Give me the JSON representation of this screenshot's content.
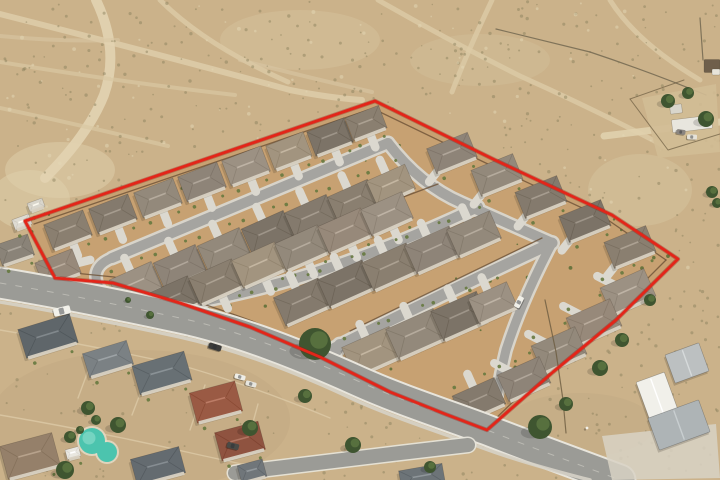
{
  "meta": {
    "description": "Oblique aerial photograph of a desert housing subdivision outlined with a red property-boundary line; older neighborhood with swimming pool at lower left, open desert with dirt trails above, white metal outbuildings at right",
    "image_width": 720,
    "image_height": 480
  },
  "colors": {
    "desert_base": "#cbb28a",
    "site_dirt": "#c7a172",
    "boundary_red": "#e32519",
    "boundary_under": "#8e1a10",
    "road_asphalt": "#9b9b96",
    "road_curb": "#e8e5dc",
    "street_asphalt": "#a5a4a0",
    "street_curb": "#d8d4ca",
    "driveway": "#dbd8cf",
    "house_wall": "#d8d1c2",
    "fence_brown": "#6d5136",
    "pool_water": "#4cc4ae",
    "tree_green": "#3f5530"
  },
  "desert": {
    "base": "#cbb28a",
    "speckle_dark": "#867d58",
    "speckle_light": "#e4d7b5",
    "patches": [
      [
        60,
        170,
        55,
        28,
        "#dfd0ac",
        0.5
      ],
      [
        300,
        40,
        80,
        30,
        "#d6c49e",
        0.45
      ],
      [
        640,
        190,
        52,
        36,
        "#d8c7a2",
        0.4
      ],
      [
        580,
        425,
        75,
        32,
        "#c3ac85",
        0.55
      ],
      [
        140,
        420,
        150,
        70,
        "#c2a681",
        0.45
      ],
      [
        480,
        60,
        70,
        26,
        "#d2c09a",
        0.4
      ],
      [
        30,
        200,
        40,
        30,
        "#e0d1ad",
        0.5
      ]
    ],
    "trails": [
      {
        "d": "M0,14 Q150,52 290,90 Q330,98 362,100",
        "w": 6,
        "c": "#ddcba7",
        "o": 0.9
      },
      {
        "d": "M96,0 Q120,50 104,95 Q88,135 45,178",
        "w": 10,
        "c": "#e2d3b1",
        "o": 0.9
      },
      {
        "d": "M160,0 Q205,45 288,82",
        "w": 5,
        "c": "#dccaa6",
        "o": 0.8
      },
      {
        "d": "M378,0 Q448,40 520,76 Q600,112 668,148",
        "w": 5,
        "c": "#dccaa6",
        "o": 0.8
      },
      {
        "d": "M492,0 Q466,55 452,92",
        "w": 5,
        "c": "#dccaa6",
        "o": 0.8
      },
      {
        "d": "M610,0 Q636,42 700,80",
        "w": 5,
        "c": "#dccaa6",
        "o": 0.8
      },
      {
        "d": "M0,62 Q120,82 235,95",
        "w": 4,
        "c": "#d9c7a3",
        "o": 0.7
      },
      {
        "d": "M0,108 Q85,126 168,146",
        "w": 4,
        "c": "#d9c7a3",
        "o": 0.7
      },
      {
        "d": "M240,60 Q310,78 372,92",
        "w": 4,
        "c": "#d9c7a3",
        "o": 0.6
      },
      {
        "d": "M604,136 L720,122",
        "w": 7,
        "c": "#e0d0ad",
        "o": 0.9
      },
      {
        "d": "M0,36 Q60,42 118,40",
        "w": 4,
        "c": "#d9c7a3",
        "o": 0.6
      }
    ],
    "fences": [
      "M496,29 L590,52",
      "M590,52 Q650,72 706,95",
      "M700,18 L703,60"
    ]
  },
  "boundary": {
    "stroke": "#e32519",
    "underlay": "#8e1a10",
    "width": 2.8,
    "points": "375,101 25,221 55,278 113,283 180,303 250,327 320,357 390,392 445,414 487,430 553,372 616,320 678,259 612,215 495,160"
  },
  "site": {
    "dirt": "#c7a172",
    "asphalt": "#a5a4a0",
    "curb": "#d8d4ca",
    "wall_color": "#6d5136",
    "shrub": "#5f7038",
    "roof_palette": [
      "#93897b",
      "#8a7f70",
      "#9c9183",
      "#847a6d",
      "#a2947f",
      "#8e8478",
      "#7c7367",
      "#97897a"
    ],
    "streets": [
      {
        "d": "M112,258 L388,143",
        "w": 10
      },
      {
        "d": "M112,258 Q92,266 97,283 Q103,301 135,311",
        "w": 9
      },
      {
        "d": "M135,311 C260,297 360,262 478,207",
        "w": 10
      },
      {
        "d": "M335,348 Q440,295 552,243",
        "w": 11
      },
      {
        "d": "M327,363 L340,345",
        "w": 12
      },
      {
        "d": "M388,143 Q420,185 462,203 L552,243",
        "w": 10
      },
      {
        "d": "M552,243 Q522,300 506,350 Q500,375 497,396",
        "w": 9
      }
    ],
    "walls": [
      "M34,224 L368,110",
      "M380,112 L492,166 L608,220 L666,260",
      "M666,260 L610,316 L549,367 L490,424",
      "M64,272 L114,277 Q180,295 252,321 Q322,351 392,386 L448,408 L478,422",
      "M150,292 L438,184",
      "M350,331 L542,238"
    ],
    "houses": [
      [
        68,
        230,
        -21,
        42,
        27,
        1,
        "S"
      ],
      [
        113,
        214,
        -21,
        42,
        27,
        3,
        "S"
      ],
      [
        158,
        198,
        -21,
        42,
        27,
        0,
        "S"
      ],
      [
        202,
        182,
        -21,
        42,
        27,
        5,
        "S"
      ],
      [
        246,
        166,
        -21,
        42,
        27,
        2,
        "S"
      ],
      [
        289,
        151,
        -21,
        40,
        26,
        4,
        "S"
      ],
      [
        330,
        137,
        -21,
        40,
        26,
        6,
        "S"
      ],
      [
        366,
        123,
        -21,
        36,
        24,
        1,
        "S"
      ],
      [
        58,
        268,
        -21,
        40,
        26,
        7,
        "E"
      ],
      [
        136,
        284,
        -24,
        46,
        29,
        2,
        "N"
      ],
      [
        180,
        267,
        -24,
        46,
        29,
        5,
        "N"
      ],
      [
        224,
        250,
        -24,
        46,
        29,
        0,
        "N"
      ],
      [
        268,
        233,
        -24,
        46,
        29,
        6,
        "N"
      ],
      [
        311,
        217,
        -24,
        46,
        29,
        3,
        "N"
      ],
      [
        353,
        201,
        -24,
        44,
        28,
        1,
        "N"
      ],
      [
        391,
        185,
        -24,
        42,
        27,
        4,
        "N"
      ],
      [
        172,
        299,
        -24,
        47,
        30,
        6,
        "S"
      ],
      [
        216,
        282,
        -24,
        47,
        30,
        1,
        "S"
      ],
      [
        259,
        265,
        -24,
        47,
        30,
        4,
        "S"
      ],
      [
        302,
        248,
        -24,
        47,
        30,
        0,
        "S"
      ],
      [
        345,
        231,
        -24,
        47,
        30,
        7,
        "S"
      ],
      [
        387,
        214,
        -24,
        45,
        29,
        2,
        "S"
      ],
      [
        302,
        302,
        -24,
        49,
        31,
        3,
        "N"
      ],
      [
        346,
        284,
        -24,
        49,
        31,
        6,
        "N"
      ],
      [
        390,
        267,
        -24,
        49,
        31,
        1,
        "N"
      ],
      [
        433,
        250,
        -24,
        49,
        31,
        5,
        "N"
      ],
      [
        474,
        234,
        -24,
        47,
        30,
        0,
        "N"
      ],
      [
        372,
        352,
        -24,
        52,
        33,
        4,
        "N"
      ],
      [
        416,
        334,
        -24,
        52,
        33,
        0,
        "N"
      ],
      [
        460,
        316,
        -24,
        50,
        32,
        6,
        "N"
      ],
      [
        493,
        303,
        -24,
        42,
        28,
        2,
        "N"
      ],
      [
        452,
        153,
        -22,
        44,
        27,
        5,
        "SW"
      ],
      [
        497,
        175,
        -22,
        45,
        28,
        0,
        "SW"
      ],
      [
        541,
        197,
        -22,
        45,
        28,
        3,
        "SW"
      ],
      [
        585,
        221,
        -22,
        45,
        28,
        6,
        "SW"
      ],
      [
        630,
        247,
        -22,
        45,
        28,
        1,
        "SW"
      ],
      [
        628,
        292,
        -24,
        48,
        30,
        2,
        "NW"
      ],
      [
        594,
        322,
        -24,
        48,
        30,
        7,
        "NW"
      ],
      [
        559,
        350,
        -24,
        48,
        30,
        0,
        "NW"
      ],
      [
        524,
        379,
        -24,
        46,
        29,
        5,
        "NW"
      ],
      [
        479,
        400,
        -24,
        46,
        29,
        3,
        "N"
      ]
    ]
  },
  "roads": {
    "asphalt": "#9b9b96",
    "curb": "#e8e5dc",
    "centerline": "#d2d0c8",
    "sidewalk": "#d6d2c6",
    "main_d": "M0,283 C60,293 120,305 180,318 C240,331 300,355 360,382 C400,400 450,416 487,430 C530,447 575,463 620,480",
    "main_w": 29,
    "sidewalk_d": "M0,302 C60,312 120,324 180,337 C238,350 296,372 355,400 C395,418 445,434 480,447 C518,461 555,471 590,480",
    "local_d": "M235,473 Q320,463 400,453 L468,445",
    "local_w": 14
  },
  "hood": {
    "ground": "#c2a681",
    "wall_color": "#dcc9a6",
    "walls": [
      "M0,330 Q90,345 180,365 Q250,385 330,418",
      "M0,415 Q100,432 200,455 L260,468",
      "M95,352 L78,398",
      "M150,368 L132,415",
      "M205,385 L190,430",
      "M258,404 L246,448"
    ],
    "houses": [
      [
        48,
        336,
        -17,
        54,
        30,
        "#5f666a"
      ],
      [
        108,
        359,
        -17,
        46,
        25,
        "#7b8184"
      ],
      [
        162,
        373,
        -16,
        54,
        30,
        "#687074"
      ],
      [
        216,
        402,
        -15,
        47,
        31,
        "#9a5a44"
      ],
      [
        240,
        441,
        -15,
        45,
        29,
        "#8f5340"
      ],
      [
        158,
        466,
        -15,
        50,
        27,
        "#646b70"
      ],
      [
        30,
        456,
        -15,
        54,
        34,
        "#95806a"
      ],
      [
        73,
        453,
        -15,
        14,
        10,
        "#e9e7e0"
      ],
      [
        252,
        471,
        -15,
        26,
        18,
        "#70767a"
      ],
      [
        422,
        477,
        -10,
        44,
        20,
        "#6d7478"
      ],
      [
        15,
        250,
        -19,
        34,
        22,
        "#8a8378"
      ],
      [
        22,
        222,
        -20,
        18,
        11,
        "#dedbd2"
      ],
      [
        36,
        205,
        -20,
        16,
        9,
        "#d9d6cc"
      ]
    ],
    "pool": {
      "cx1": 92,
      "cy1": 441,
      "r1": 13,
      "cx2": 107,
      "cy2": 452,
      "r2": 10,
      "water": "#4cc4ae",
      "light": "#7fd8c6"
    }
  },
  "east": {
    "fence": "M545,300 L556,352 L563,400 L566,433",
    "pad": "602,436 716,424 720,478 612,480",
    "pad_fill": "#d8d2c4",
    "buildings": [
      [
        687,
        363,
        -20,
        36,
        30,
        "#bcc0c1"
      ],
      [
        657,
        396,
        -20,
        30,
        40,
        "#f1f0ea"
      ],
      [
        679,
        425,
        -20,
        54,
        34,
        "#aeb4b6"
      ]
    ]
  },
  "ne_property": {
    "pad": "642,98 716,84 720,152 658,158",
    "pad_fill": "#d2bc95",
    "fences": [
      "M630,99 L668,150 L720,134",
      "M630,99 L684,80"
    ],
    "structures": [
      [
        692,
        124,
        -7,
        40,
        13,
        "#e8e6de"
      ],
      [
        676,
        109,
        -7,
        12,
        9,
        "#d9d6cc"
      ],
      [
        712,
        66,
        0,
        16,
        13,
        "#6f5f4b"
      ],
      [
        716,
        72,
        0,
        8,
        6,
        "#e7e4da"
      ]
    ]
  },
  "trees": {
    "base": "#3f5530",
    "highlight": "#5a7340",
    "items": [
      [
        315,
        344,
        16
      ],
      [
        540,
        427,
        12
      ],
      [
        566,
        404,
        7
      ],
      [
        600,
        368,
        8
      ],
      [
        622,
        340,
        7
      ],
      [
        650,
        300,
        6
      ],
      [
        88,
        408,
        7
      ],
      [
        118,
        425,
        8
      ],
      [
        70,
        437,
        6
      ],
      [
        250,
        428,
        8
      ],
      [
        305,
        396,
        7
      ],
      [
        353,
        445,
        8
      ],
      [
        65,
        470,
        9
      ],
      [
        668,
        101,
        7
      ],
      [
        688,
        93,
        6
      ],
      [
        706,
        119,
        8
      ],
      [
        712,
        192,
        6
      ],
      [
        717,
        203,
        5
      ],
      [
        430,
        467,
        6
      ],
      [
        96,
        420,
        5
      ],
      [
        150,
        315,
        4
      ],
      [
        128,
        300,
        3
      ],
      [
        80,
        430,
        4
      ]
    ]
  },
  "vehicles": [
    [
      62,
      311,
      -14,
      17,
      8,
      "#f2f1ea"
    ],
    [
      215,
      347,
      17,
      13,
      6,
      "#3c3c3a"
    ],
    [
      240,
      377,
      15,
      11,
      5,
      "#eeede6"
    ],
    [
      251,
      384,
      15,
      11,
      5,
      "#e6e5de"
    ],
    [
      519,
      302,
      -63,
      12,
      6,
      "#f0efe8"
    ],
    [
      233,
      446,
      15,
      12,
      6,
      "#4a4a46"
    ],
    [
      692,
      137,
      3,
      10,
      5,
      "#e5e2d8"
    ],
    [
      681,
      132,
      8,
      9,
      5,
      "#8a8580"
    ]
  ],
  "person": [
    587,
    428
  ]
}
